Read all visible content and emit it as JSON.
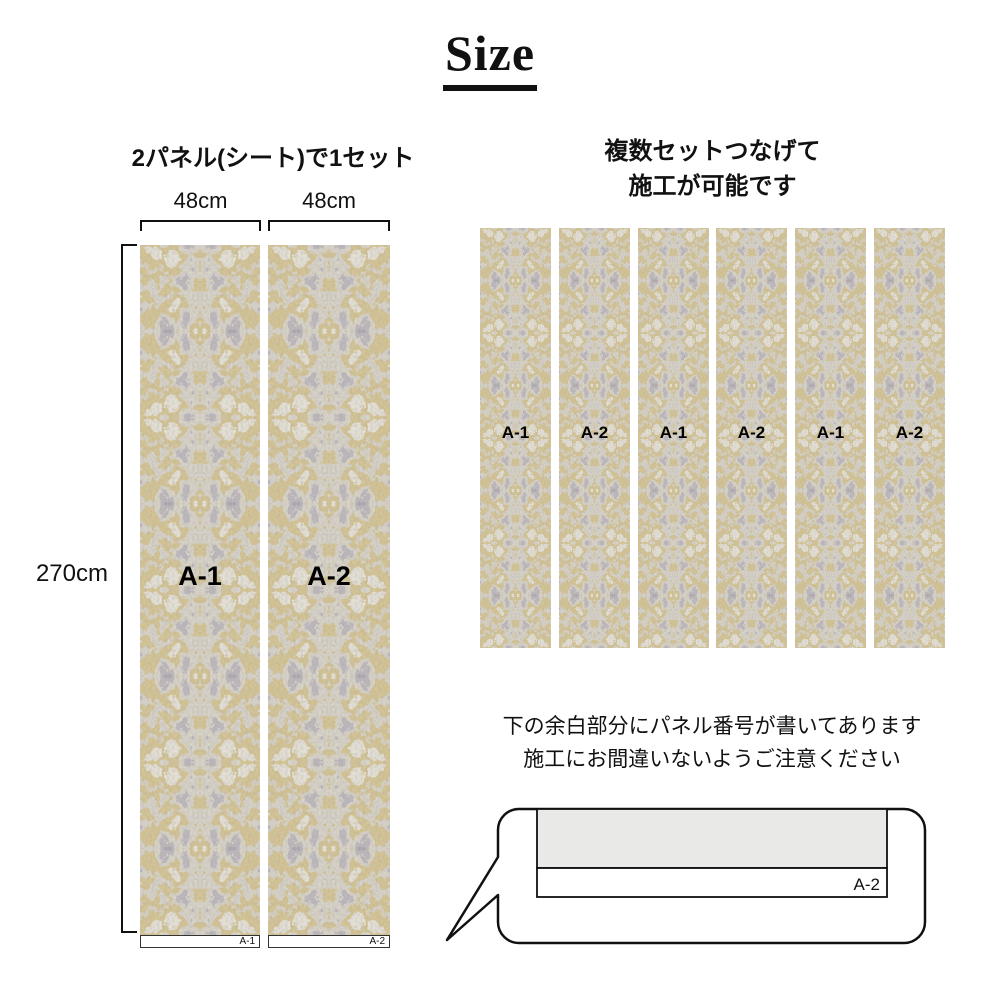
{
  "title": {
    "text": "Size"
  },
  "left_section": {
    "heading": "2パネル(シート)で1セット",
    "width_labels": [
      "48cm",
      "48cm"
    ],
    "height_label": "270cm",
    "panels": [
      {
        "center_label": "A-1",
        "corner_label": "A-1"
      },
      {
        "center_label": "A-2",
        "corner_label": "A-2"
      }
    ]
  },
  "right_section": {
    "heading_line1": "複数セットつなげて",
    "heading_line2": "施工が可能です",
    "panel_labels": [
      "A-1",
      "A-2",
      "A-1",
      "A-2",
      "A-1",
      "A-2"
    ]
  },
  "note": {
    "line1": "下の余白部分にパネル番号が書いてあります",
    "line2": "施工にお間違いないようご注意ください",
    "diagram_label": "A-2"
  },
  "colors": {
    "text": "#111111",
    "texture_base": "#beb5a4",
    "texture_gray_purple": "#8a8290",
    "texture_gold": "#b89a4f",
    "texture_cream": "#ddd6c2",
    "diagram_panel_gray": "#e9e9e7",
    "background": "#ffffff"
  }
}
